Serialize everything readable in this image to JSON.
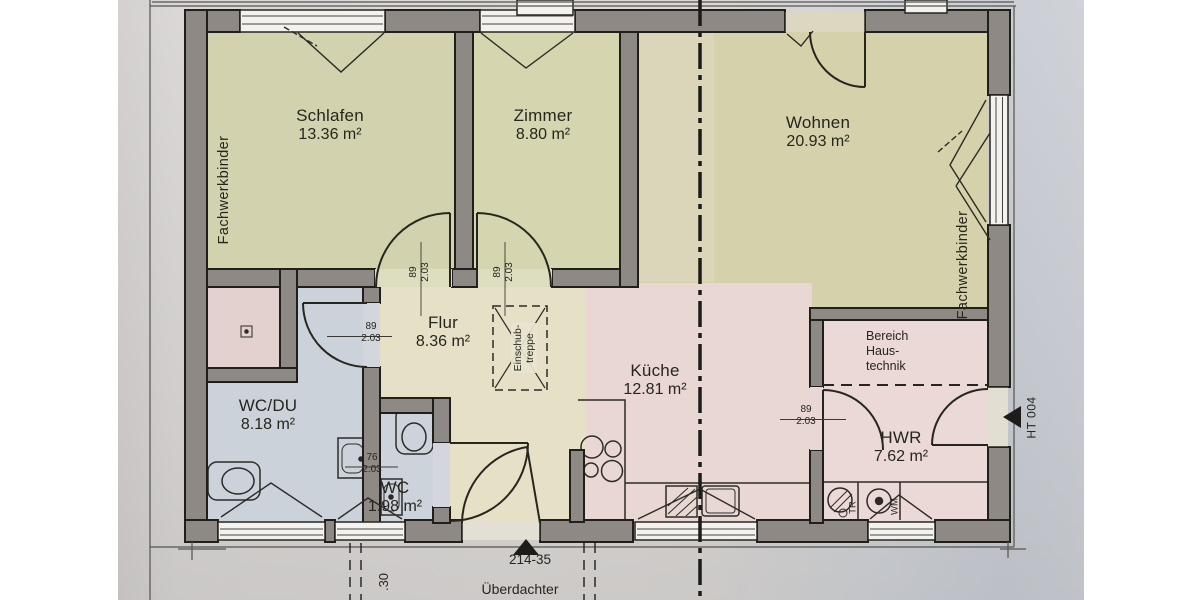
{
  "plan": {
    "rooms": [
      {
        "name": "Schlafen",
        "area": "13.36 m²"
      },
      {
        "name": "Zimmer",
        "area": "8.80 m²"
      },
      {
        "name": "Wohnen",
        "area": "20.93 m²"
      },
      {
        "name": "Flur",
        "area": "8.36 m²"
      },
      {
        "name": "Küche",
        "area": "12.81 m²"
      },
      {
        "name": "WC/DU",
        "area": "8.18 m²"
      },
      {
        "name": "WC",
        "area": "1.98 m²"
      },
      {
        "name": "HWR",
        "area": "7.62 m²"
      }
    ],
    "zones": {
      "haustechnik_line1": "Bereich",
      "haustechnik_line2": "Haus-",
      "haustechnik_line3": "technik",
      "loft_ladder_line1": "Einschub-",
      "loft_ladder_line2": "treppe"
    },
    "labels": {
      "truss_left": "Fachwerkbinder",
      "truss_right": "Fachwerkbinder",
      "entry_door": "HT 004",
      "plan_number": "214-35",
      "covered": "Überdachter",
      "cut_dimension": ".30",
      "dryer": "TR",
      "washer": "WM"
    },
    "door_dims": [
      {
        "w": "89",
        "h": "2.03"
      },
      {
        "w": "89",
        "h": "2.03"
      },
      {
        "w": "89",
        "h": "2.03"
      },
      {
        "w": "76",
        "h": "2.03"
      },
      {
        "w": "89",
        "h": "2.03"
      }
    ],
    "colors": {
      "wall": "#8e8984",
      "room_green": "#d2d3ae",
      "room_beige": "#e6e1c6",
      "room_pink": "#e8d7d3",
      "room_blue": "#ccd2da",
      "paper": "#d7d4d2"
    }
  }
}
